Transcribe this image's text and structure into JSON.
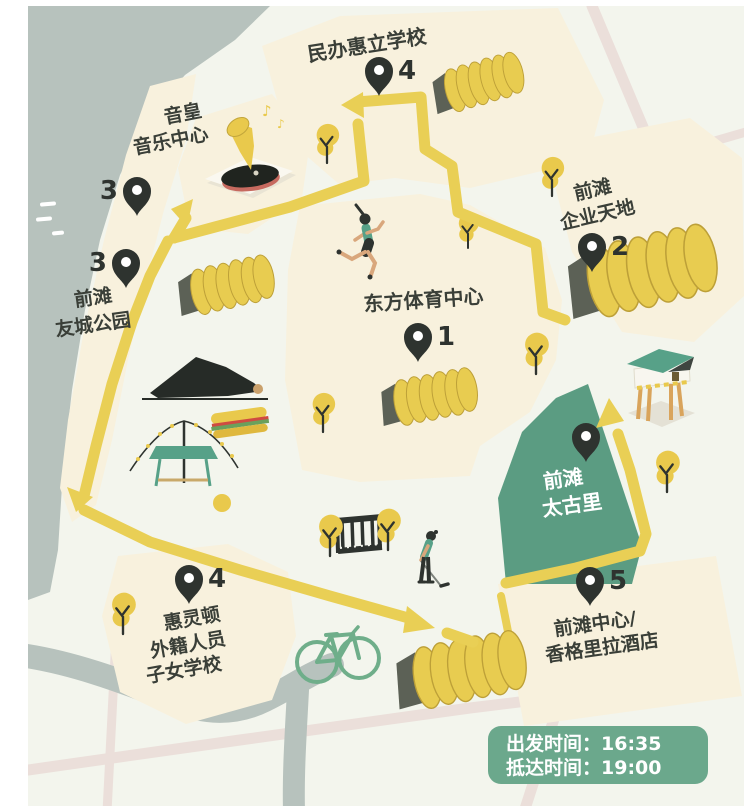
{
  "locations": {
    "sports_center": {
      "number": "1",
      "name": "东方体育中心"
    },
    "enterprise_sky": {
      "number": "2",
      "name_line1": "前滩",
      "name_line2": "企业天地"
    },
    "music_center": {
      "number": "3",
      "name_line1": "音皇",
      "name_line2": "音乐中心"
    },
    "youcheng_park": {
      "number": "3",
      "name_line1": "前滩",
      "name_line2": "友城公园"
    },
    "huili_school": {
      "number": "4",
      "name": "民办惠立学校"
    },
    "wellington_school": {
      "number": "4",
      "name_line1": "惠灵顿",
      "name_line2": "外籍人员",
      "name_line3": "子女学校"
    },
    "qiantan_center": {
      "number": "5",
      "name_line1": "前滩中心/",
      "name_line2": "香格里拉酒店"
    },
    "taikoo_li": {
      "name_line1": "前滩",
      "name_line2": "太古里"
    }
  },
  "info_box": {
    "departure": "出发时间：16:35",
    "arrival": "抵达时间：19:00"
  },
  "colors": {
    "background": "#f3f5ed",
    "water": "#b7c2bd",
    "land": "#f8f1dd",
    "route_yellow": "#e9cf55",
    "taikoo_green": "#5b9c82",
    "info_box_green": "#6ba88c",
    "pin_dark": "#2e332f",
    "road_pink": "#ebdfda",
    "bike_green": "#6fae8a"
  }
}
